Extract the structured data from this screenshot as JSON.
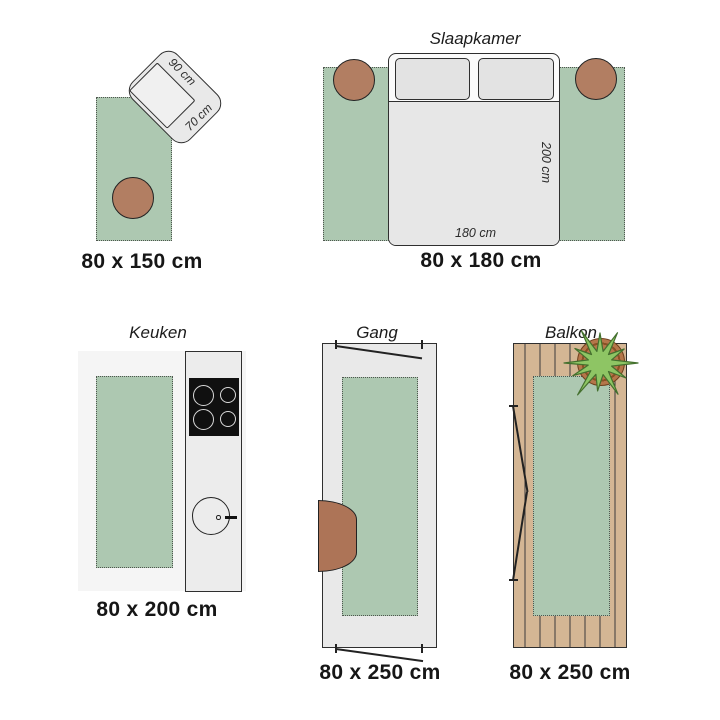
{
  "colors": {
    "rug_green": "#adc8b1",
    "pouf_brown": "#b27e62",
    "console_brown": "#ad7457",
    "wood_tan": "#d4b694",
    "plant_green": "#8ec564",
    "pot_brown": "#b5764a",
    "outline": "#2f2f2f"
  },
  "sections": {
    "lounge": {
      "size_label": "80 x 150 cm",
      "chair_depth_label": "90 cm",
      "chair_width_label": "70 cm"
    },
    "bedroom": {
      "title": "Slaapkamer",
      "size_label": "80 x 180 cm",
      "bed_length_label": "200 cm",
      "bed_width_label": "180 cm"
    },
    "kitchen": {
      "title": "Keuken",
      "size_label": "80 x 200 cm"
    },
    "hallway": {
      "title": "Gang",
      "size_label": "80 x 250 cm"
    },
    "balcony": {
      "title": "Balkon",
      "size_label": "80 x 250 cm"
    }
  }
}
